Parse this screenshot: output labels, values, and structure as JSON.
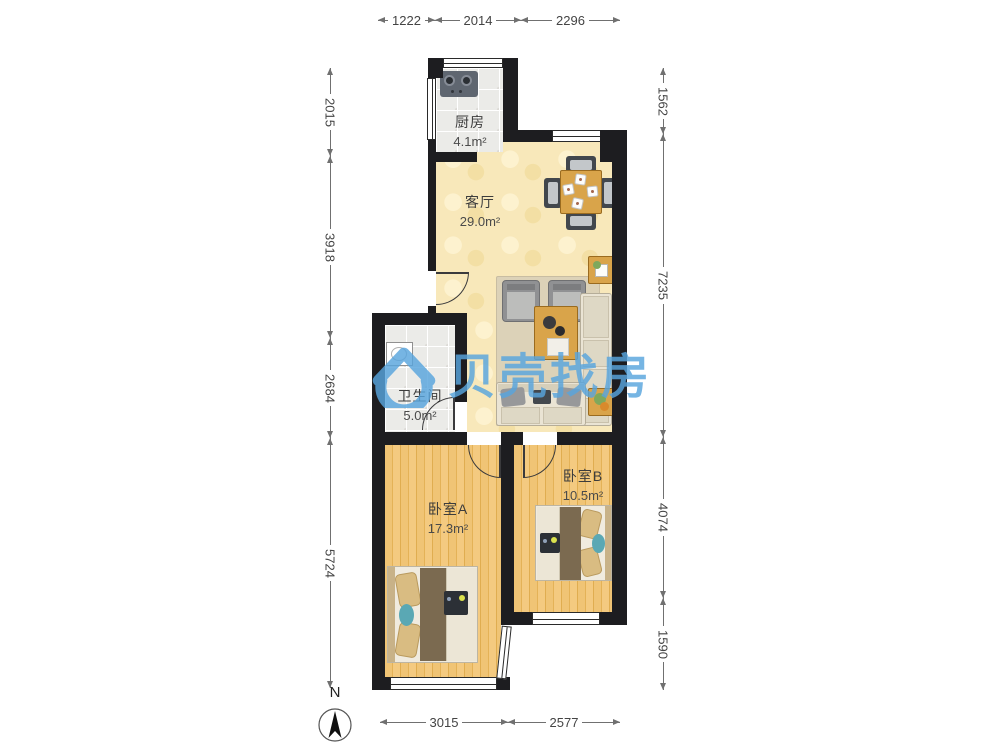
{
  "watermark": {
    "text": "贝壳找房",
    "color": "#58a5de"
  },
  "compass": {
    "label": "N"
  },
  "rooms": {
    "kitchen": {
      "name": "厨房",
      "area": "4.1m²"
    },
    "living": {
      "name": "客厅",
      "area": "29.0m²"
    },
    "bathroom": {
      "name": "卫生间",
      "area": "5.0m²"
    },
    "bedroom_a": {
      "name": "卧室A",
      "area": "17.3m²"
    },
    "bedroom_b": {
      "name": "卧室B",
      "area": "10.5m²"
    }
  },
  "dimensions": {
    "top": [
      "1222",
      "2014",
      "2296"
    ],
    "bottom": [
      "3015",
      "2577"
    ],
    "left": [
      "2015",
      "3918",
      "2684",
      "5724"
    ],
    "right": [
      "1562",
      "7235",
      "4074",
      "1590"
    ]
  },
  "colors": {
    "wall": "#1d1d20",
    "living_floor": "#f8e8ba",
    "wood_floor": "#eec06d",
    "tile_floor": "#ebebe8",
    "watermark_blue": "#58a5de"
  }
}
